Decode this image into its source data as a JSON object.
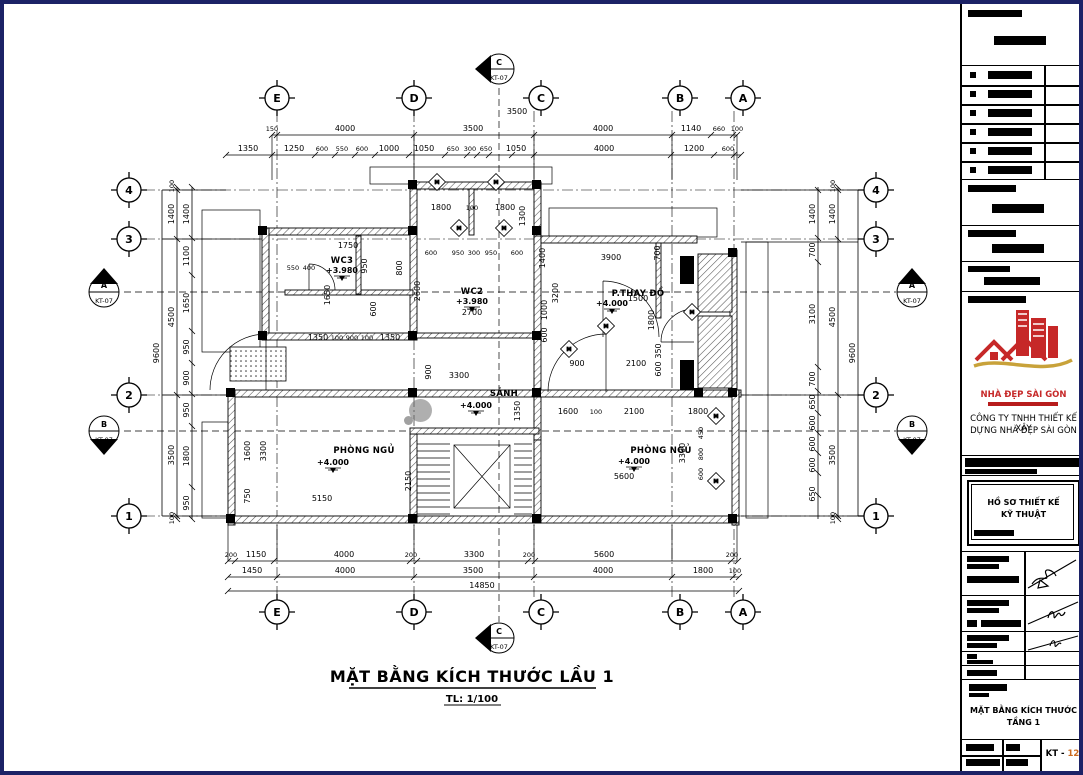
{
  "page": {
    "title": "MẶT BẰNG KÍCH THƯỚC  LẦU 1",
    "scale": "TL: 1/100"
  },
  "grid": {
    "cols": [
      "E",
      "D",
      "C",
      "B",
      "A"
    ],
    "rows": [
      "4",
      "3",
      "2",
      "1"
    ]
  },
  "sections": {
    "a": "A",
    "b": "B",
    "c": "C",
    "ref": "KT-07"
  },
  "door_tag": "M",
  "rooms": {
    "wc3": {
      "name": "WC3",
      "level": "+3.980"
    },
    "wc2": {
      "name": "WC2",
      "level": "+3.980"
    },
    "sanh": {
      "name": "SẢNH",
      "level": "+4.000"
    },
    "thaydo": {
      "name": "P.THAY ĐỒ",
      "level": "+4.000"
    },
    "ngu1": {
      "name": "PHÒNG NGỦ",
      "level": "+4.000"
    },
    "ngu2": {
      "name": "PHÒNG NGỦ",
      "level": "+4.000"
    }
  },
  "dims": {
    "top_extra": "3500",
    "top1": [
      "150",
      "4000",
      "3500",
      "4000",
      "1140",
      "660",
      "100"
    ],
    "top2": [
      "1350",
      "1250",
      "600",
      "550",
      "600",
      "1000",
      "1050",
      "650",
      "300",
      "650",
      "1050",
      "4000",
      "1200",
      "600"
    ],
    "bottom1": [
      "200",
      "1150",
      "4000",
      "200",
      "3300",
      "200",
      "5600",
      "200"
    ],
    "bottom2": [
      "1450",
      "4000",
      "3500",
      "4000",
      "1800",
      "100"
    ],
    "total": "14850",
    "left_out": "9600",
    "left_mid": [
      "100",
      "1400",
      "4500",
      "3500",
      "100"
    ],
    "left_in": [
      "1400",
      "1100",
      "1650",
      "950",
      "900",
      "950",
      "1800",
      "950"
    ],
    "right_out": "9600",
    "right_mid": [
      "100",
      "1400",
      "4500",
      "3500",
      "100"
    ],
    "right_in": [
      "1400",
      "700",
      "3100",
      "700",
      "650",
      "600",
      "600",
      "600",
      "650"
    ],
    "inner": [
      "1800",
      "100",
      "1800",
      "1300",
      "1750",
      "950",
      "600",
      "950",
      "300",
      "950",
      "600",
      "1400",
      "3900",
      "700",
      "2600",
      "2700",
      "3200",
      "1000",
      "600",
      "1500",
      "1800",
      "1650",
      "550",
      "400",
      "1350",
      "100",
      "900",
      "100",
      "1350",
      "600",
      "800",
      "3300",
      "900",
      "1350",
      "1600",
      "2150",
      "5150",
      "1600",
      "3300",
      "750",
      "5600",
      "100",
      "2100",
      "1800",
      "3300",
      "900",
      "2100",
      "600",
      "350",
      "450",
      "800",
      "600"
    ]
  },
  "titleblock": {
    "logo_text": "NHÀ ĐẸP SÀI GÒN",
    "company1": "CÔNG TY TNHH THIẾT KẾ XÂY",
    "company2": "DỰNG NHÀ ĐẸP SÀI GÒN",
    "dossier1": "HỒ SƠ THIẾT KẾ",
    "dossier2": "KỸ THUẬT",
    "sheet1": "MẶT BẰNG KÍCH THƯỚC",
    "sheet2": "TẦNG 1",
    "sheet_no_prefix": "KT - ",
    "sheet_no": "12"
  },
  "colors": {
    "page_border": "#1c2266",
    "logo_red": "#c62828",
    "logo_gold": "#c8a23a",
    "sheet_no_orange": "#cc6a1f"
  }
}
